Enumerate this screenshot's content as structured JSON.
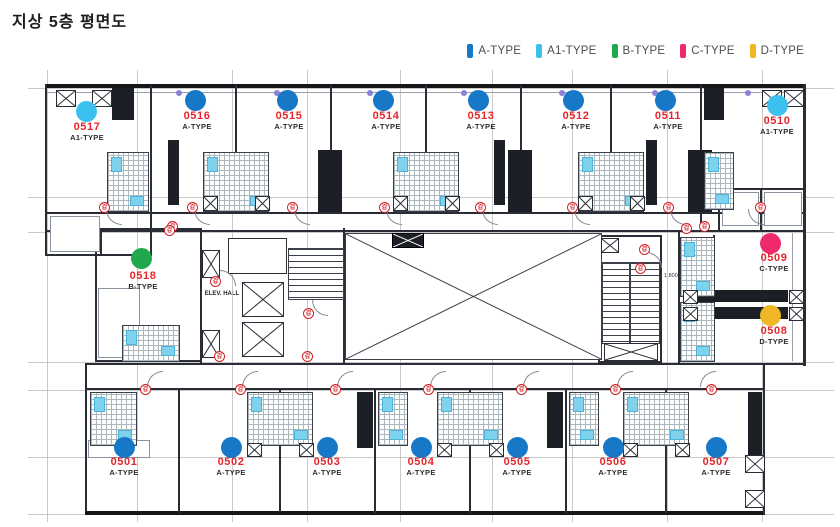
{
  "title": "지상 5층 평면도",
  "legend": {
    "items": [
      {
        "label": "A-TYPE",
        "color": "#1878c8"
      },
      {
        "label": "A1-TYPE",
        "color": "#3cc1ee"
      },
      {
        "label": "B-TYPE",
        "color": "#1fa84c"
      },
      {
        "label": "C-TYPE",
        "color": "#ee2a6d"
      },
      {
        "label": "D-TYPE",
        "color": "#eeb723"
      }
    ]
  },
  "plan": {
    "fire_door_glyph": "갑",
    "core": {
      "comm_room_label": "통신실",
      "elev_hall_label": "ELEV. HALL",
      "stair_dim_label": "1,800"
    },
    "units": [
      {
        "number": "0517",
        "type_label": "A1-TYPE",
        "dot": {
          "x": 86,
          "y": 111
        },
        "label": {
          "x": 87,
          "y": 121
        }
      },
      {
        "number": "0516",
        "type_label": "A-TYPE",
        "dot": {
          "x": 195,
          "y": 100
        },
        "label": {
          "x": 197,
          "y": 110
        }
      },
      {
        "number": "0515",
        "type_label": "A-TYPE",
        "dot": {
          "x": 287,
          "y": 100
        },
        "label": {
          "x": 289,
          "y": 110
        }
      },
      {
        "number": "0514",
        "type_label": "A-TYPE",
        "dot": {
          "x": 383,
          "y": 100
        },
        "label": {
          "x": 386,
          "y": 110
        }
      },
      {
        "number": "0513",
        "type_label": "A-TYPE",
        "dot": {
          "x": 478,
          "y": 100
        },
        "label": {
          "x": 481,
          "y": 110
        }
      },
      {
        "number": "0512",
        "type_label": "A-TYPE",
        "dot": {
          "x": 573,
          "y": 100
        },
        "label": {
          "x": 576,
          "y": 110
        }
      },
      {
        "number": "0511",
        "type_label": "A-TYPE",
        "dot": {
          "x": 665,
          "y": 100
        },
        "label": {
          "x": 668,
          "y": 110
        }
      },
      {
        "number": "0510",
        "type_label": "A1-TYPE",
        "dot": {
          "x": 777,
          "y": 105
        },
        "label": {
          "x": 777,
          "y": 115
        }
      },
      {
        "number": "0518",
        "type_label": "B-TYPE",
        "dot": {
          "x": 141,
          "y": 258
        },
        "label": {
          "x": 143,
          "y": 270
        }
      },
      {
        "number": "0509",
        "type_label": "C-TYPE",
        "dot": {
          "x": 770,
          "y": 243
        },
        "label": {
          "x": 774,
          "y": 252
        }
      },
      {
        "number": "0508",
        "type_label": "D-TYPE",
        "dot": {
          "x": 770,
          "y": 315
        },
        "label": {
          "x": 774,
          "y": 325
        }
      },
      {
        "number": "0501",
        "type_label": "A-TYPE",
        "dot": {
          "x": 124,
          "y": 447
        },
        "label": {
          "x": 124,
          "y": 456
        }
      },
      {
        "number": "0502",
        "type_label": "A-TYPE",
        "dot": {
          "x": 231,
          "y": 447
        },
        "label": {
          "x": 231,
          "y": 456
        }
      },
      {
        "number": "0503",
        "type_label": "A-TYPE",
        "dot": {
          "x": 327,
          "y": 447
        },
        "label": {
          "x": 327,
          "y": 456
        }
      },
      {
        "number": "0504",
        "type_label": "A-TYPE",
        "dot": {
          "x": 421,
          "y": 447
        },
        "label": {
          "x": 421,
          "y": 456
        }
      },
      {
        "number": "0505",
        "type_label": "A-TYPE",
        "dot": {
          "x": 517,
          "y": 447
        },
        "label": {
          "x": 517,
          "y": 456
        }
      },
      {
        "number": "0506",
        "type_label": "A-TYPE",
        "dot": {
          "x": 613,
          "y": 447
        },
        "label": {
          "x": 613,
          "y": 456
        }
      },
      {
        "number": "0507",
        "type_label": "A-TYPE",
        "dot": {
          "x": 716,
          "y": 447
        },
        "label": {
          "x": 716,
          "y": 456
        }
      }
    ]
  }
}
